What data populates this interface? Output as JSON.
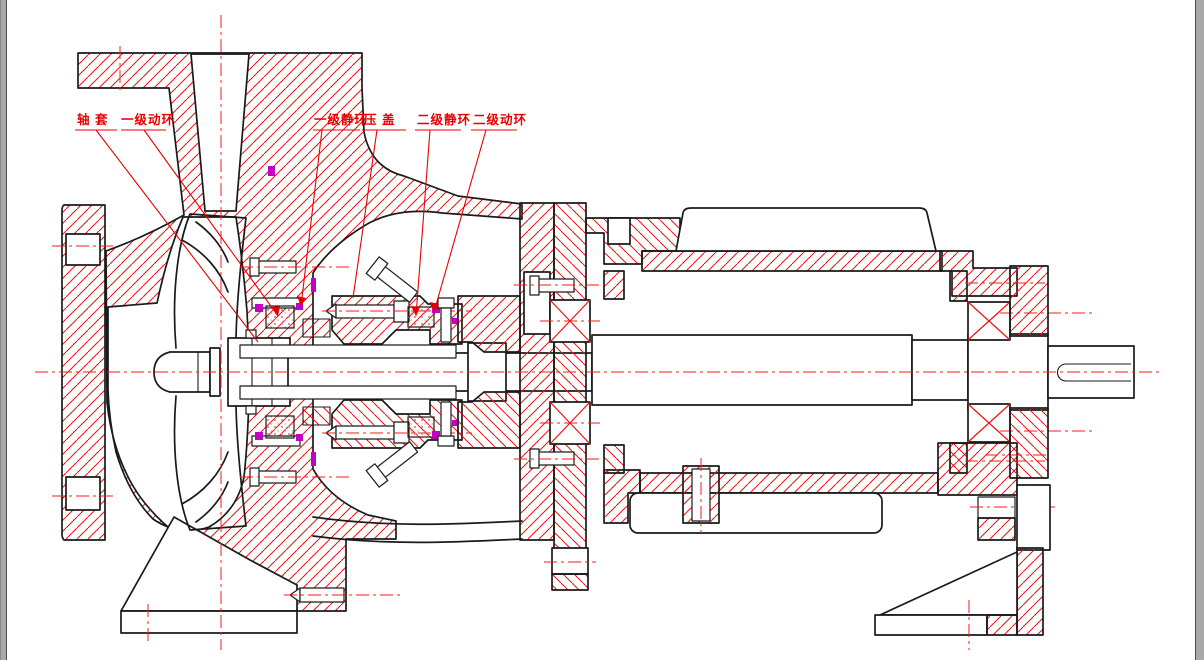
{
  "drawing": {
    "labels": [
      {
        "id": "shaft-sleeve",
        "text": "轴 套"
      },
      {
        "id": "stage1-rotating-ring",
        "text": "一级动环"
      },
      {
        "id": "stage1-stationary-ring",
        "text": "一级静环"
      },
      {
        "id": "gland",
        "text": "压 盖"
      },
      {
        "id": "stage2-stationary-ring",
        "text": "二级静环"
      },
      {
        "id": "stage2-rotating-ring",
        "text": "二级动环"
      }
    ],
    "colors": {
      "outline": "#1a1a1a",
      "hatch": "#ee1111",
      "centerline": "#ff1a1a",
      "label": "#e80000",
      "seal_accent": "#c400c4",
      "frame": "#a9a9a9",
      "canvas": "#ffffff"
    }
  }
}
